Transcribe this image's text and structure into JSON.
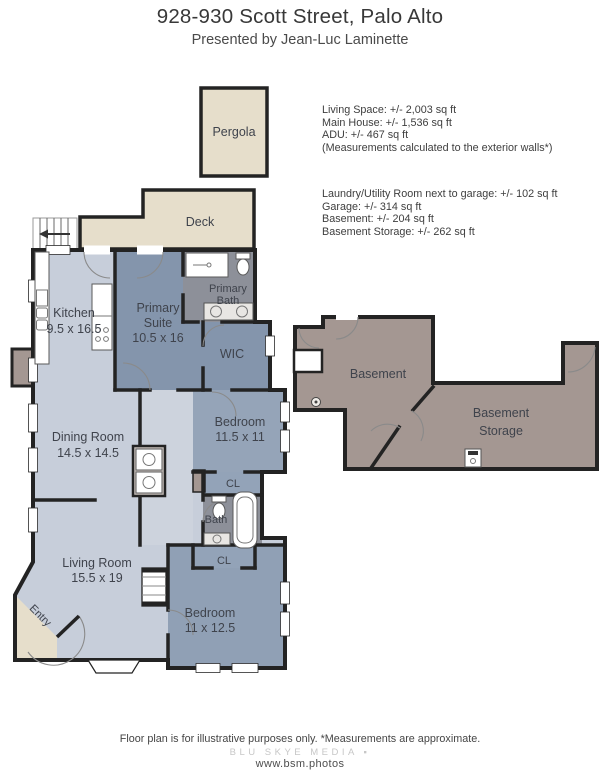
{
  "header": {
    "title": "928-930 Scott Street, Palo Alto",
    "subtitle": "Presented by Jean-Luc Laminette"
  },
  "area_summary": {
    "main": [
      "Living Space: +/- 2,003 sq ft",
      "Main House: +/- 1,536 sq ft",
      "ADU: +/- 467 sq ft",
      "(Measurements calculated to the exterior walls*)"
    ],
    "other": [
      "Laundry/Utility Room next to garage: +/- 102 sq ft",
      "Garage: +/- 314 sq ft",
      "Basement: +/- 204 sq ft",
      "Basement Storage: +/- 262 sq ft"
    ]
  },
  "rooms": {
    "pergola": {
      "label": "Pergola"
    },
    "deck": {
      "label": "Deck"
    },
    "kitchen": {
      "label": "Kitchen",
      "dims": "9.5 x 16.5"
    },
    "primary_suite": {
      "line1": "Primary",
      "line2": "Suite",
      "dims": "10.5 x 16"
    },
    "primary_bath": {
      "line1": "Primary",
      "line2": "Bath"
    },
    "wic": {
      "label": "WIC"
    },
    "bedroom1": {
      "label": "Bedroom",
      "dims": "11.5 x 11"
    },
    "dining": {
      "label": "Dining Room",
      "dims": "14.5 x 14.5"
    },
    "closet1": {
      "label": "CL"
    },
    "bath": {
      "label": "Bath"
    },
    "closet2": {
      "label": "CL"
    },
    "living": {
      "label": "Living Room",
      "dims": "15.5 x 19"
    },
    "entry": {
      "label": "Entry"
    },
    "bedroom2": {
      "label": "Bedroom",
      "dims": "11 x 12.5"
    },
    "basement": {
      "label": "Basement"
    },
    "basement_storage": {
      "line1": "Basement",
      "line2": "Storage"
    }
  },
  "footer": {
    "disclaimer": "Floor plan is for illustrative purposes only. *Measurements are approximate.",
    "brand": "BLU SKYE MEDIA ▪",
    "website": "www.bsm.photos"
  },
  "colors": {
    "interior_light": "#c7ceda",
    "hallway_light": "#cdd3dd",
    "bedroom_blue": "#90a0b5",
    "suite_blue": "#8495ac",
    "bath_gray": "#8d9099",
    "outdoor_tan": "#e6decb",
    "basement_mauve": "#a49792",
    "wall": "#232323"
  }
}
